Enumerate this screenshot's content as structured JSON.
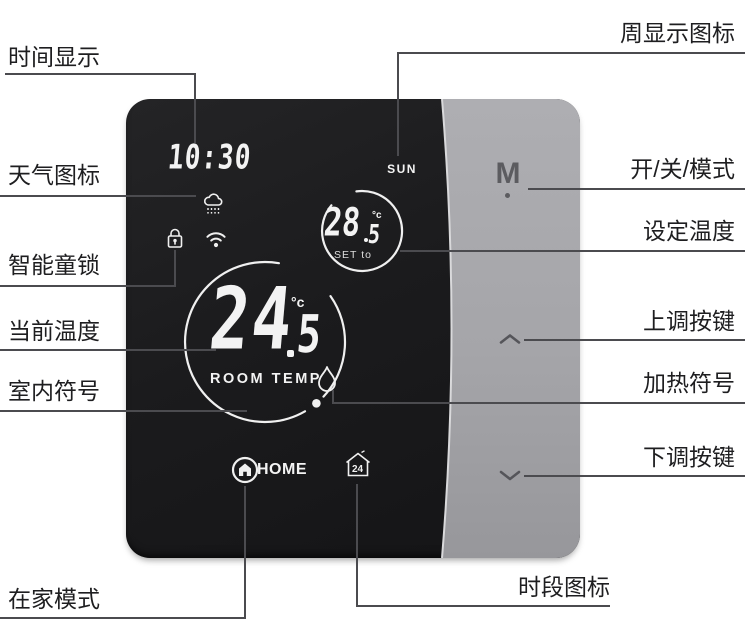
{
  "colors": {
    "background": "#ffffff",
    "screen": "#1a1a1c",
    "panel": "#a6a6aa",
    "leader_line": "#4b4b4f",
    "label_text": "#1e1e20",
    "display_text": "#f3f3f3",
    "button_glyph": "#5c5c60"
  },
  "annotations": {
    "left": [
      {
        "id": "time-display",
        "text": "时间显示"
      },
      {
        "id": "weather-icon",
        "text": "天气图标"
      },
      {
        "id": "child-lock",
        "text": "智能童锁"
      },
      {
        "id": "current-temp",
        "text": "当前温度"
      },
      {
        "id": "indoor-symbol",
        "text": "室内符号"
      },
      {
        "id": "home-mode",
        "text": "在家模式"
      }
    ],
    "right": [
      {
        "id": "week-display",
        "text": "周显示图标"
      },
      {
        "id": "power-mode",
        "text": "开/关/模式"
      },
      {
        "id": "set-temp",
        "text": "设定温度"
      },
      {
        "id": "up-key",
        "text": "上调按键"
      },
      {
        "id": "heating-symbol",
        "text": "加热符号"
      },
      {
        "id": "down-key",
        "text": "下调按键"
      },
      {
        "id": "period-icon",
        "text": "时段图标"
      }
    ]
  },
  "device": {
    "time": "10:30",
    "day": "SUN",
    "set_temp": {
      "value": "28",
      "decimal": "5",
      "unit": "°c",
      "label": "SET to"
    },
    "room_temp": {
      "value": "24",
      "decimal": "5",
      "unit": "°c",
      "label": "ROOM TEMP"
    },
    "home_label": "HOME",
    "mode_button": "M",
    "period_icon_text": "24",
    "icons": [
      "rain-cloud",
      "padlock",
      "wifi",
      "flame",
      "home",
      "period-24h"
    ]
  }
}
